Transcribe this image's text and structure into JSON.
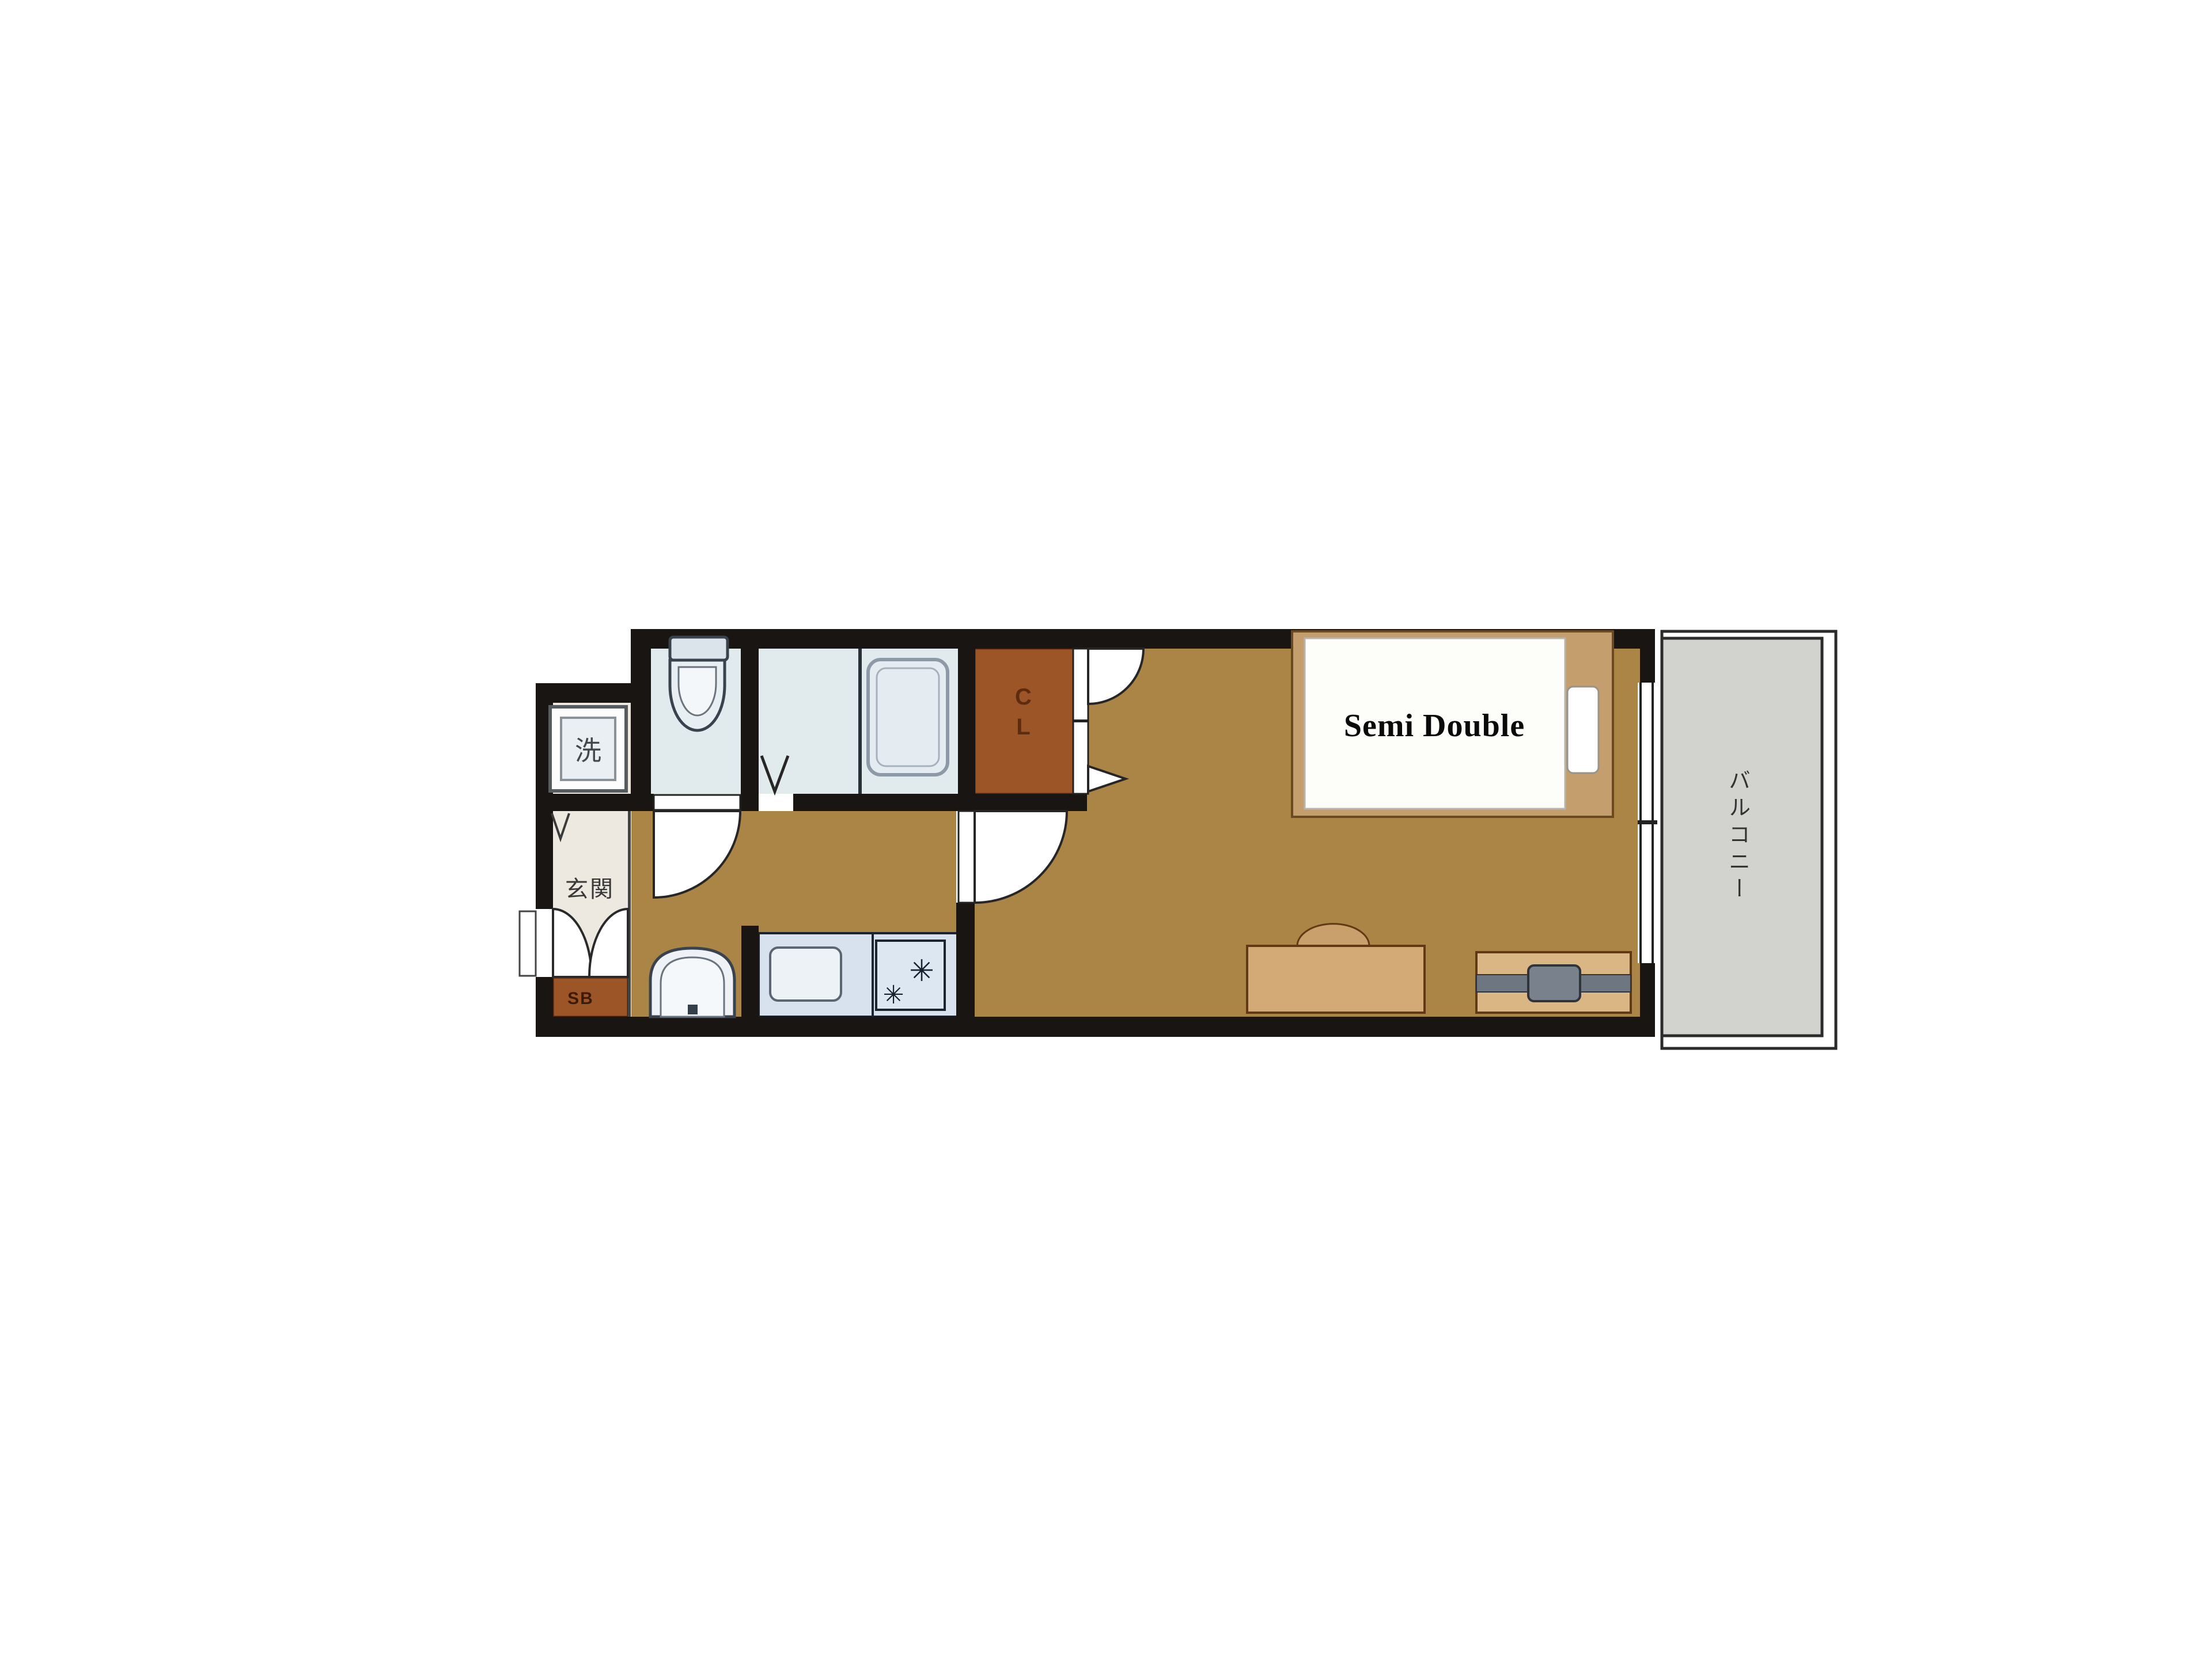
{
  "plan": {
    "labels": {
      "genkan": "玄関",
      "washer": "洗",
      "shoe_box": "SB",
      "closet": "CL",
      "bed": "Semi Double",
      "balcony": "バルコニー"
    },
    "icons": {
      "stove_burner": "✳"
    },
    "colors": {
      "wall": "#181512",
      "floor_tan": "#ab8545",
      "closet_brown": "#9c5526",
      "wet_room_blue": "#e1eaec",
      "kitchen_counter_blue": "#d8e2ee",
      "genkan_cream": "#ede8e0",
      "balcony_gray": "#d2d2cf",
      "bed_frame_tan": "#c59e6e",
      "furniture_tan": "#d3aa76",
      "tv_gray": "#6e7681",
      "background": "#ffffff"
    }
  }
}
